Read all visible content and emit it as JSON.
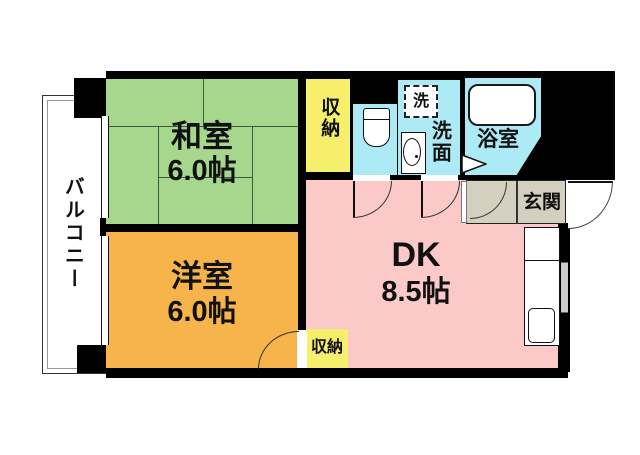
{
  "plan_title": "1DK floor plan",
  "wall_color": "#000000",
  "rooms": {
    "balcony": {
      "label": "バルコニー",
      "color": "#ffffff"
    },
    "washitsu": {
      "label": "和室",
      "area": "6.0帖",
      "color": "#a6d78d"
    },
    "youshitsu": {
      "label": "洋室",
      "area": "6.0帖",
      "color": "#f6b44b"
    },
    "dk": {
      "label": "DK",
      "area": "8.5帖",
      "color": "#fac9c8"
    },
    "closet_top": {
      "label": "収納",
      "color": "#f6ef6c"
    },
    "closet_bottom": {
      "label": "収納",
      "color": "#f6ef6c"
    },
    "washroom": {
      "label": "洗面",
      "color": "#aceaf6"
    },
    "washer": {
      "label": "洗"
    },
    "bathroom": {
      "label": "浴室",
      "color": "#aceaf6"
    },
    "toilet": {
      "color": "#aceaf6"
    },
    "genkan": {
      "label": "玄関",
      "color": "#d4d0c0"
    }
  }
}
